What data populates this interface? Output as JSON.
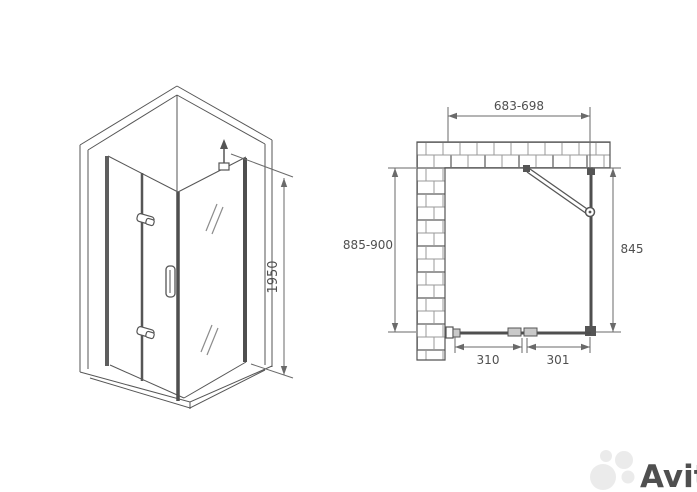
{
  "drawing": {
    "type": "shower-enclosure-technical-drawing",
    "front_view": {
      "height_dimension": "1950"
    },
    "plan_view": {
      "top_width_dimension": "683-698",
      "left_depth_dimension": "885-900",
      "right_side_dimension": "845",
      "bottom_left_segment": "310",
      "bottom_right_segment": "301"
    }
  },
  "watermark": {
    "brand": "Avito"
  },
  "colors": {
    "background": "#ffffff",
    "line": "#565656",
    "glass_frame": "#4f4f4f",
    "dimension": "#6a6a6a",
    "brick_joint": "#9a9a9a",
    "watermark": "#ebebeb"
  }
}
